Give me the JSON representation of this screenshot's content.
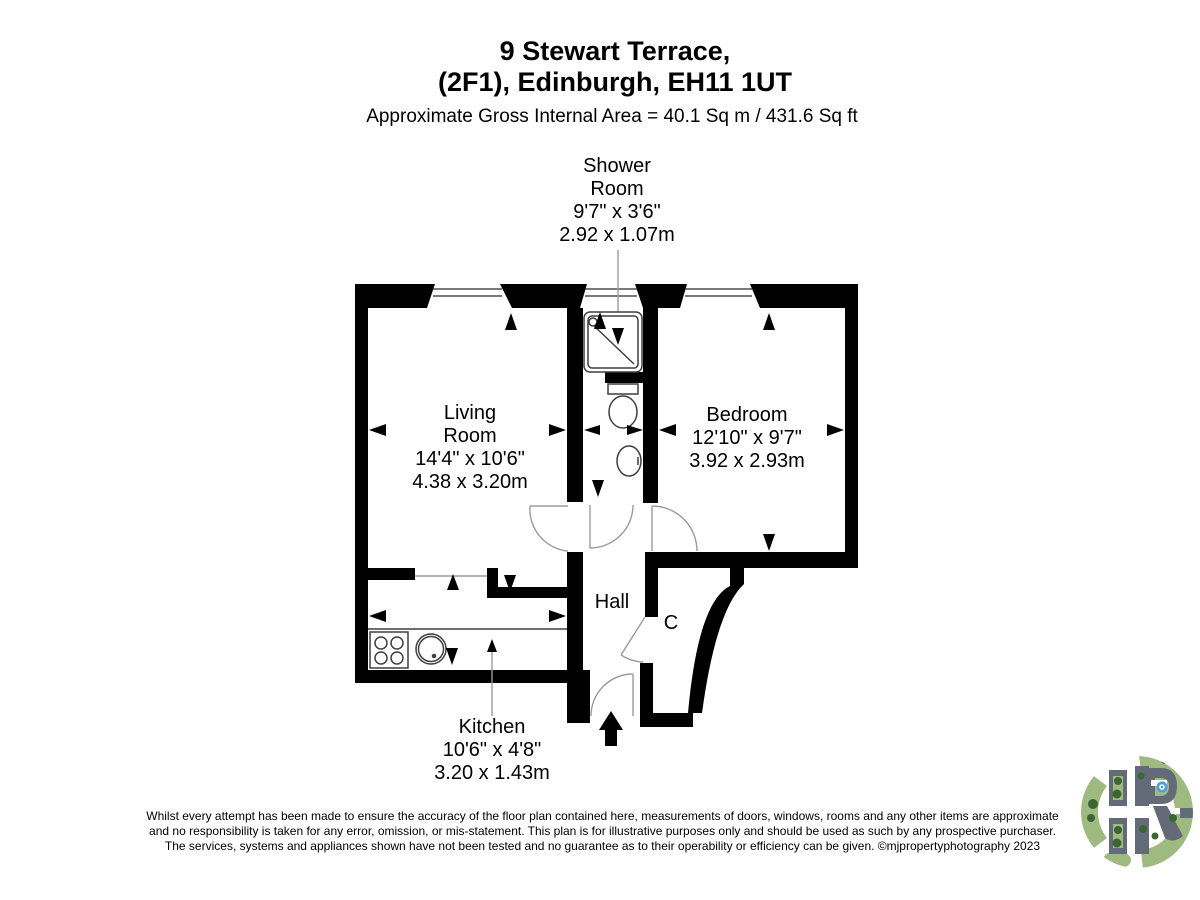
{
  "header": {
    "title_line1": "9 Stewart Terrace,",
    "title_line2": "(2F1), Edinburgh, EH11 1UT",
    "subtitle": "Approximate Gross Internal Area = 40.1 Sq m / 431.6 Sq ft"
  },
  "rooms": {
    "shower": {
      "name_line1": "Shower",
      "name_line2": "Room",
      "imperial": "9'7\" x 3'6\"",
      "metric": "2.92 x 1.07m"
    },
    "living": {
      "name_line1": "Living",
      "name_line2": "Room",
      "imperial": "14'4\" x 10'6\"",
      "metric": "4.38 x 3.20m"
    },
    "bedroom": {
      "name": "Bedroom",
      "imperial": "12'10\" x 9'7\"",
      "metric": "3.92 x 2.93m"
    },
    "kitchen": {
      "name": "Kitchen",
      "imperial": "10'6\" x 4'8\"",
      "metric": "3.20 x 1.43m"
    },
    "hall": {
      "name": "Hall"
    },
    "cupboard": {
      "name": "C"
    }
  },
  "disclaimer": {
    "line1": "Whilst every attempt has been made to ensure the accuracy of the floor plan contained here, measurements of doors, windows, rooms and any other items are approximate",
    "line2": "and no responsibility is taken for any error, omission, or mis-statement. This plan is for illustrative purposes only and should be used as such by any prospective purchaser.",
    "line3": "The services, systems and appliances shown have not been tested and no guarantee as to their operability or efficiency can be given. ©mjpropertyphotography 2023"
  },
  "colors": {
    "wall": "#000000",
    "door_line": "#9b9b9b",
    "fixture_line": "#3f3f3f",
    "logo_grey": "#646b78",
    "logo_green": "#9fba80",
    "logo_green_dark": "#3c6534",
    "logo_blue": "#4aa0dc"
  }
}
